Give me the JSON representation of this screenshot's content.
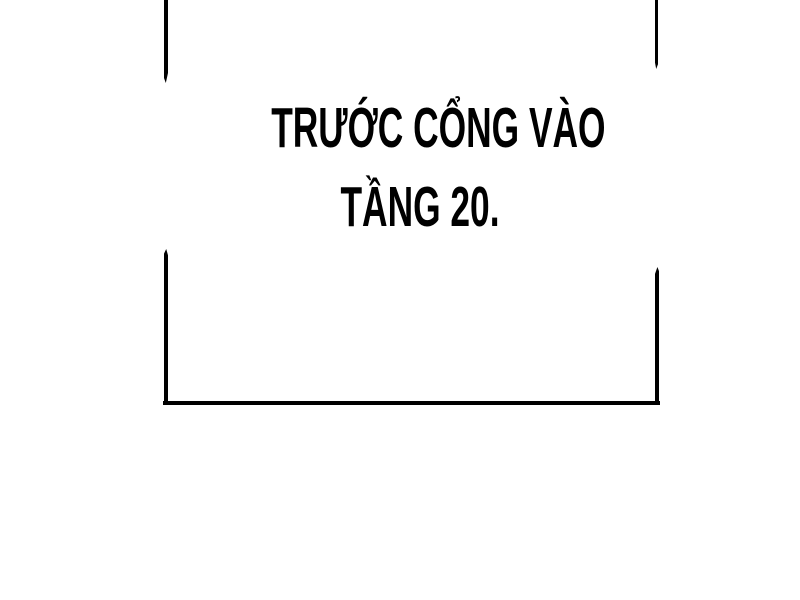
{
  "page": {
    "kind": "comic-page-fragment"
  },
  "colors": {
    "ink": "#000000",
    "paper": "#ffffff"
  },
  "caption": {
    "line1": "TRƯỚC CỔNG VÀO",
    "line2": "TẦNG 20."
  }
}
